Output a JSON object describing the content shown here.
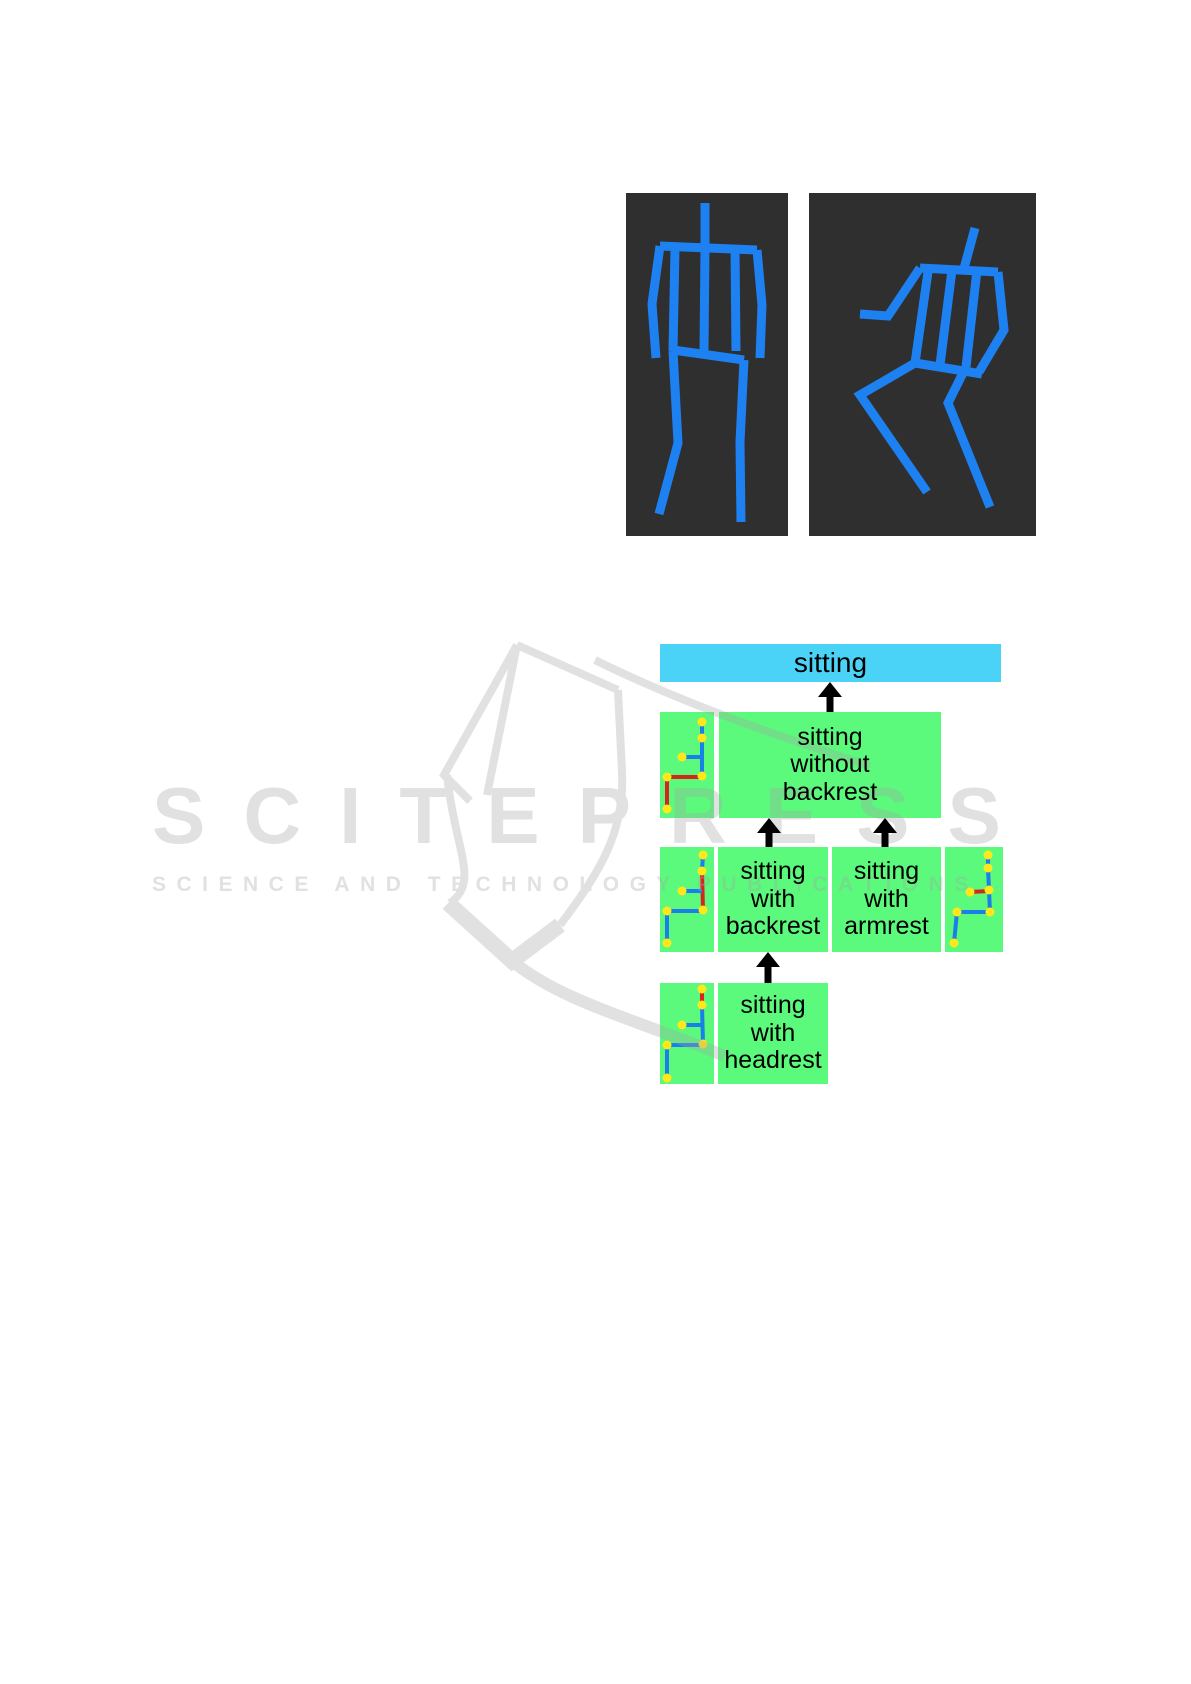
{
  "figure": {
    "panels": [
      {
        "id": "standing-pose-panel",
        "pose": "standing",
        "background": "#2f2f2f",
        "skeleton_color": "#1d81f2"
      },
      {
        "id": "sitting-pose-panel",
        "pose": "sitting",
        "background": "#2f2f2f",
        "skeleton_color": "#1d81f2"
      }
    ]
  },
  "diagram": {
    "type": "hierarchy",
    "root": {
      "id": "sitting",
      "label": "sitting",
      "color": "#4ad3f7"
    },
    "nodes": [
      {
        "id": "sitting-without-backrest",
        "lines": [
          "sitting",
          "without",
          "backrest"
        ],
        "parent": "sitting",
        "color": "#5bfa7c",
        "thumbnail_highlight": "legs"
      },
      {
        "id": "sitting-with-backrest",
        "lines": [
          "sitting",
          "with",
          "backrest"
        ],
        "parent": "sitting-without-backrest",
        "color": "#5bfa7c",
        "thumbnail_highlight": "back"
      },
      {
        "id": "sitting-with-armrest",
        "lines": [
          "sitting",
          "with",
          "armrest"
        ],
        "parent": "sitting-without-backrest",
        "color": "#5bfa7c",
        "thumbnail_highlight": "arm"
      },
      {
        "id": "sitting-with-headrest",
        "lines": [
          "sitting",
          "with",
          "headrest"
        ],
        "parent": "sitting-with-backrest",
        "color": "#5bfa7c",
        "thumbnail_highlight": "head"
      }
    ],
    "arrow_color": "#000000",
    "thumbnail_colors": {
      "background": "#5bfa7c",
      "bone": "#1b7fe9",
      "highlight": "#d6251c",
      "joint": "#ffe71a"
    }
  },
  "watermark": {
    "title": "SCITEPRESS",
    "subtitle": "SCIENCE AND TECHNOLOGY PUBLICATIONS",
    "color": "#a6a6a6"
  }
}
